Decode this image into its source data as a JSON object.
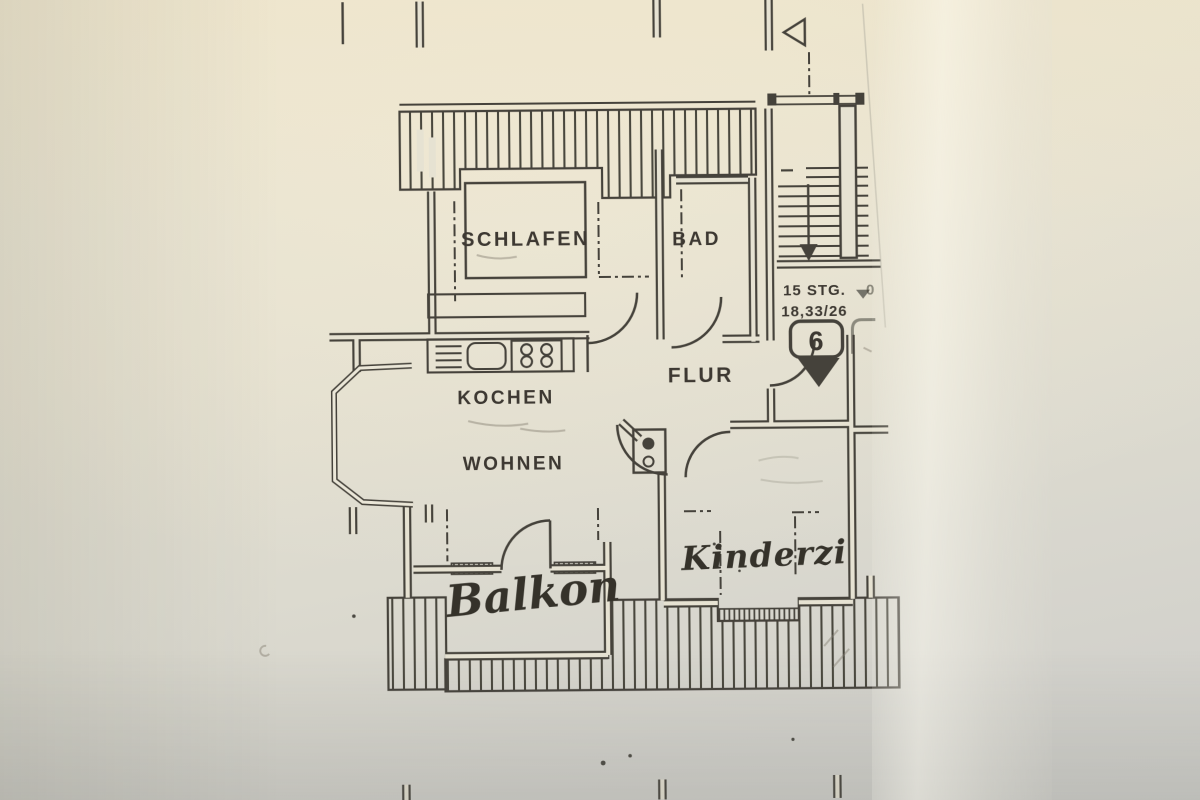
{
  "plan": {
    "rooms": {
      "schlafen": "SCHLAFEN",
      "bad": "BAD",
      "kochen": "KOCHEN",
      "wohnen": "WOHNEN",
      "flur": "FLUR"
    },
    "handwritten": {
      "balkon": "Balkon",
      "kinderzimmer": "Kinderzi"
    },
    "stairs": {
      "steps": "15 STG.",
      "rise_run": "18,33/26"
    },
    "badge": {
      "number": "6"
    },
    "partial_edge_text": "0"
  },
  "colors": {
    "paper": "#e6e2d2",
    "ink": "#45423a",
    "pencil": "#827e70"
  }
}
